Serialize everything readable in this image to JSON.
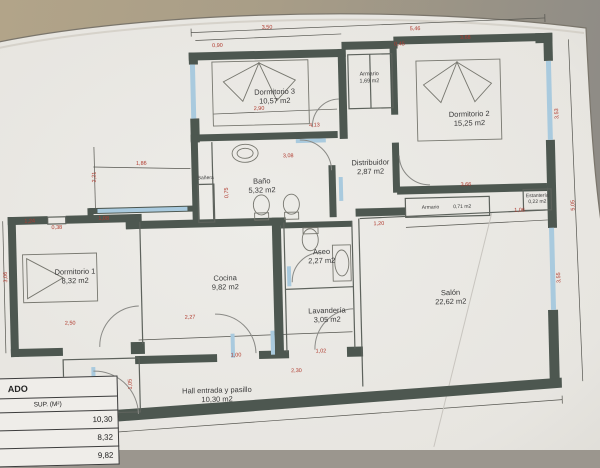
{
  "meta": {
    "kind": "photographed architectural floor plan (Spanish apartment)"
  },
  "colors": {
    "wall": "#4d5750",
    "window": "#a9cade",
    "line": "#6b6e68",
    "dimension": "#b03a2e",
    "paper": "#e9e7e2",
    "backdrop_left": "#b2a489",
    "backdrop_right": "#8f8c86"
  },
  "rooms": [
    {
      "id": "dormitorio-3",
      "name": "Dormitorio 3",
      "area": "10,57 m2",
      "x": 278,
      "y": 96,
      "cls": ""
    },
    {
      "id": "armario-top",
      "name": "Armario",
      "area": "1,69 m2",
      "x": 373,
      "y": 80,
      "cls": "small"
    },
    {
      "id": "dormitorio-2",
      "name": "Dormitorio 2",
      "area": "15,25 m2",
      "x": 472,
      "y": 123,
      "cls": ""
    },
    {
      "id": "banera",
      "name": "Bañera",
      "area": "",
      "x": 207,
      "y": 176,
      "cls": "tiny"
    },
    {
      "id": "bano",
      "name": "Baño",
      "area": "5,32 m2",
      "x": 263,
      "y": 185,
      "cls": ""
    },
    {
      "id": "distribuidor",
      "name": "Distribuidor",
      "area": "2,87 m2",
      "x": 372,
      "y": 169,
      "cls": ""
    },
    {
      "id": "armario-pasillo",
      "name": "Armario",
      "area": "0,71 m2",
      "x": 447,
      "y": 211,
      "cls": "tiny inline"
    },
    {
      "id": "estanteria",
      "name": "Estantería",
      "area": "0,22 m2",
      "x": 538,
      "y": 205,
      "cls": "tiny"
    },
    {
      "id": "dormitorio-1",
      "name": "Dormitorio 1",
      "area": "8,32 m2",
      "x": 74,
      "y": 271,
      "cls": ""
    },
    {
      "id": "cocina",
      "name": "Cocina",
      "area": "9,82 m2",
      "x": 224,
      "y": 281,
      "cls": ""
    },
    {
      "id": "aseo",
      "name": "Aseo",
      "area": "2,27 m2",
      "x": 321,
      "y": 257,
      "cls": ""
    },
    {
      "id": "lavanderia",
      "name": "Lavandería",
      "area": "3,05 m2",
      "x": 325,
      "y": 316,
      "cls": ""
    },
    {
      "id": "salon",
      "name": "Salón",
      "area": "22,62 m2",
      "x": 449,
      "y": 301,
      "cls": ""
    },
    {
      "id": "hall",
      "name": "Hall entrada y pasillo",
      "area": "10,30 m2",
      "x": 213,
      "y": 393,
      "cls": ""
    },
    {
      "id": "armario-hall",
      "name": "Armario",
      "area": "",
      "x": 76,
      "y": 378,
      "cls": "tiny"
    }
  ],
  "dimensions": [
    {
      "v": "0,90",
      "x": 222,
      "y": 44
    },
    {
      "v": "3,50",
      "x": 272,
      "y": 27
    },
    {
      "v": "5,46",
      "x": 420,
      "y": 32
    },
    {
      "v": "0,45",
      "x": 404,
      "y": 47
    },
    {
      "v": "3,68",
      "x": 470,
      "y": 42
    },
    {
      "v": "2,90",
      "x": 262,
      "y": 108
    },
    {
      "v": "4,13",
      "x": 317,
      "y": 126
    },
    {
      "v": "3,08",
      "x": 290,
      "y": 156
    },
    {
      "v": "0,75",
      "x": 228,
      "y": 191,
      "rot": true
    },
    {
      "v": "3,53",
      "x": 560,
      "y": 120,
      "rot": true
    },
    {
      "v": "5,05",
      "x": 574,
      "y": 212,
      "rot": true
    },
    {
      "v": "3,55",
      "x": 558,
      "y": 284,
      "rot": true
    },
    {
      "v": "3,66",
      "x": 467,
      "y": 189
    },
    {
      "v": "1,06",
      "x": 520,
      "y": 216
    },
    {
      "v": "1,20",
      "x": 379,
      "y": 226
    },
    {
      "v": "1,86",
      "x": 143,
      "y": 160
    },
    {
      "v": "2,21",
      "x": 96,
      "y": 172,
      "rot": true
    },
    {
      "v": "1,24",
      "x": 30,
      "y": 215
    },
    {
      "v": "0,38",
      "x": 57,
      "y": 222
    },
    {
      "v": "1,08",
      "x": 104,
      "y": 214
    },
    {
      "v": "3,06",
      "x": 5,
      "y": 270,
      "rot": true
    },
    {
      "v": "2,50",
      "x": 68,
      "y": 318
    },
    {
      "v": "2,27",
      "x": 188,
      "y": 315
    },
    {
      "v": "1,00",
      "x": 233,
      "y": 354
    },
    {
      "v": "1,02",
      "x": 318,
      "y": 352
    },
    {
      "v": "2,30",
      "x": 293,
      "y": 371
    },
    {
      "v": "1,05",
      "x": 127,
      "y": 380,
      "rot": true
    },
    {
      "v": "0,45",
      "x": 62,
      "y": 441
    }
  ],
  "table": {
    "title": "ADO",
    "col_header": "SUP. (M²)",
    "rows": [
      "10,30",
      "8,32",
      "9,82"
    ]
  }
}
